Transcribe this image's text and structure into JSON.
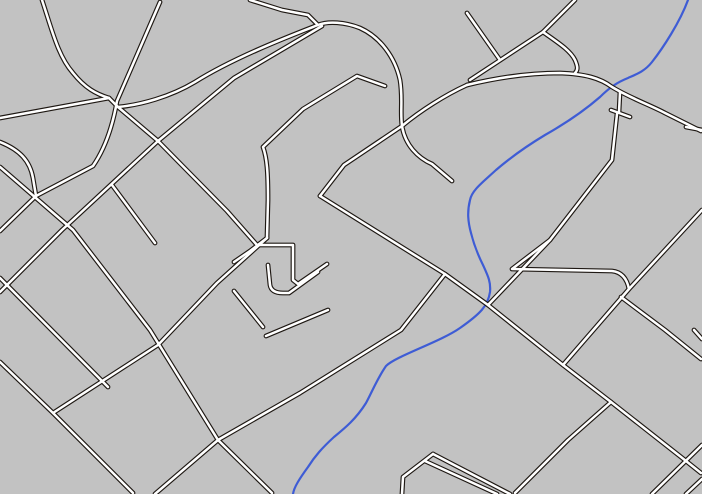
{
  "map": {
    "kind": "street-map-render",
    "width": 702,
    "height": 494,
    "colors": {
      "background": "#c2c2c2",
      "road_casing": "#1e1813",
      "road_fill": "#ffffff",
      "river": "#3e5cd5"
    },
    "stroke_widths": {
      "road_casing": 4.8,
      "road_fill": 2.5,
      "river": 2.2
    },
    "river": {
      "name": "river-line",
      "d": "M 688,0 C 680,22 663,48 652,62 C 645,71 637,74 628,78 C 618,82 610,87 600,97 C 585,110 568,122 545,135 C 525,147 510,158 496,170 C 483,182 472,190 470,200 C 467,212 468,222 471,233 C 474,245 477,253 483,265 C 488,276 491,282 490,292 C 488,306 480,314 460,328 C 440,342 396,356 386,366 C 377,379 372,392 366,403 C 356,419 345,428 334,437 C 322,448 315,456 308,467 C 300,478 294,487 293,494"
    },
    "roads": [
      {
        "name": "road-curve-northwest",
        "d": "M 42,0 C 52,30 58,56 73,73 C 85,88 96,94 109,98"
      },
      {
        "name": "road-west-feeder",
        "d": "M 0,118 L 109,98"
      },
      {
        "name": "road-steep-north",
        "d": "M 160,2 L 117,101 C 112,130 104,150 93,166 L 36,196 L 0,231"
      },
      {
        "name": "road-curvy-west",
        "d": "M 0,142 C 20,150 30,161 33,178 L 36,196"
      },
      {
        "name": "road-diagonal-sw-long",
        "d": "M 0,167 L 73,230 L 150,330 L 218,440 L 272,493"
      },
      {
        "name": "road-central-diagonal-a",
        "d": "M 109,98 L 118,107 L 158,141 L 227,211 L 257,245"
      },
      {
        "name": "road-central-diagonal-b",
        "d": "M 322,26 L 234,78 L 158,141 L 62,230 L 0,292"
      },
      {
        "name": "road-curve-sweep",
        "d": "M 318,25 C 290,36 235,57 195,82 C 170,97 140,105 118,107"
      },
      {
        "name": "road-kinked-top",
        "d": "M 250,0 L 282,10 L 308,15 L 318,25"
      },
      {
        "name": "road-highway-curve-top",
        "d": "M 318,25 C 328,21 345,22 360,28 C 380,37 395,57 400,80 C 403,98 400,112 402,126 C 405,145 418,158 432,164 L 452,181"
      },
      {
        "name": "road-branch-to-curve",
        "d": "M 385,86 L 357,76 L 303,109 L 263,147 C 267,158 268,172 268,200 L 267,238"
      },
      {
        "name": "road-west-stub-mid",
        "d": "M 234,262 L 250,251 L 267,238"
      },
      {
        "name": "road-mid-diagonal-sw",
        "d": "M 267,238 L 217,283 L 158,345 L 53,413"
      },
      {
        "name": "road-bottomleft-diag",
        "d": "M 0,362 L 53,413 L 133,493"
      },
      {
        "name": "road-bottomleft-link",
        "d": "M 0,278 L 108,387"
      },
      {
        "name": "road-hook-outer",
        "d": "M 257,245 L 293,245 L 293,280 L 298,284 L 327,264"
      },
      {
        "name": "road-hook-inner",
        "d": "M 268,265 L 270,285 C 271,291 276,293 283,293 L 289,293 L 318,272"
      },
      {
        "name": "road-dead-end-spur",
        "d": "M 112,185 L 155,243"
      },
      {
        "name": "road-stub-pair-a",
        "d": "M 234,291 L 263,327"
      },
      {
        "name": "road-stub-pair-b",
        "d": "M 328,310 L 266,336"
      },
      {
        "name": "road-cross-southwest",
        "d": "M 445,274 L 401,330 L 300,393 L 218,440 L 155,494"
      },
      {
        "name": "road-main-artery-se",
        "d": "M 320,196 L 445,274 L 488,305 L 563,365 L 611,402 L 681,457 L 701,473"
      },
      {
        "name": "road-river-crossing",
        "d": "M 467,85 C 445,95 420,111 402,126 L 344,165 L 320,196"
      },
      {
        "name": "road-highway-east",
        "d": "M 467,85 C 500,77 530,73 560,73 C 585,74 600,78 612,87 C 630,98 650,105 665,113 L 701,131"
      },
      {
        "name": "road-topright-diag-long",
        "d": "M 575,0 L 543,32 L 470,80"
      },
      {
        "name": "road-topright-diag-short",
        "d": "M 467,13 L 500,60"
      },
      {
        "name": "road-topright-branch",
        "d": "M 543,32 C 557,42 570,50 575,60 C 578,67 578,70 575,73"
      },
      {
        "name": "road-hammer-stub",
        "d": "M 620,92 L 619,112"
      },
      {
        "name": "road-hammer-crossbar",
        "d": "M 611,110 L 630,117"
      },
      {
        "name": "road-east-diagonal-sw",
        "d": "M 617,114 L 612,160 L 550,240 L 488,305"
      },
      {
        "name": "road-z-shaped",
        "d": "M 550,240 L 512,269 L 612,271 C 622,272 627,279 629,289"
      },
      {
        "name": "road-east-artery",
        "d": "M 702,210 L 629,289 L 563,365"
      },
      {
        "name": "road-east-branch-se",
        "d": "M 621,297 L 665,330 L 701,359"
      },
      {
        "name": "road-right-edge-stub",
        "d": "M 686,127 L 702,130"
      },
      {
        "name": "road-corner-piece-ne",
        "d": "M 694,330 L 702,339"
      },
      {
        "name": "road-south-branch",
        "d": "M 611,402 L 568,440 L 515,493"
      },
      {
        "name": "road-corner-cross-se",
        "d": "M 702,445 L 652,494"
      },
      {
        "name": "road-corner-bottom-right",
        "d": "M 686,494 L 702,479"
      },
      {
        "name": "road-lambda-left-arm",
        "d": "M 433,454 L 403,477 L 402,494"
      },
      {
        "name": "road-lambda-right-arm",
        "d": "M 433,454 L 510,494"
      },
      {
        "name": "road-lambda-parallel",
        "d": "M 425,461 L 497,494"
      }
    ]
  }
}
